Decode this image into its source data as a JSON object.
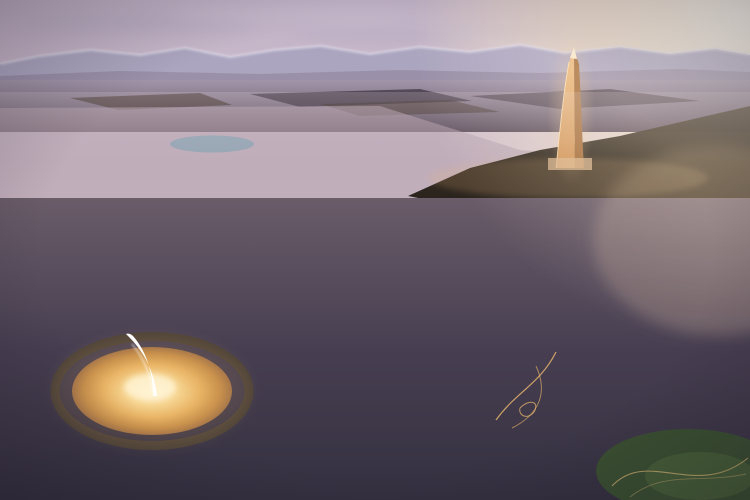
{
  "meta": {
    "title": "Dusk aerial rendering of a master-planned desert city",
    "landmarks": [
      "mountain-range",
      "sun-glow",
      "iconic-golden-tower",
      "cbd-cluster",
      "central-monument-plaza",
      "crescent-buildings",
      "green-boulevards",
      "city-park",
      "lakes"
    ]
  },
  "scene": {
    "seed": 1337,
    "counts": {
      "mid_buildings": 640,
      "mid_lights": 170,
      "desert_lights": 20,
      "cbd_towers": 30,
      "cbd_back": 16,
      "tower_windows": 95,
      "fg_buildings": 560,
      "fg_trees": 350,
      "park_trees": 42,
      "plaza_rays": 36,
      "rim_lights": 40
    },
    "palette": {
      "sky_top": "#c2b3c7",
      "sky_mid": "#d8c6d1",
      "sky_horizon": "#eedfdc",
      "cloud": "#b3a9bf",
      "sun_core": "#fff8e8",
      "sun_warm": "#f8e2bd",
      "warm_wash": "#f6c18c",
      "mountain": "#aaa3bf",
      "mountain_snow": "#dcd8e6",
      "ridge_near": "#968ba2",
      "plain_top": "#a295a9",
      "plain_bottom": "#5c4e5c",
      "field_dark": "#332a37",
      "field_brown": "#3d3028",
      "desert_top": "#372e23",
      "desert_bottom": "#1f1a14",
      "mid_base": "#b29fac",
      "mid_tints": [
        "#d8c4c6",
        "#cbb3bd",
        "#e2d1cb",
        "#c0acba",
        "#d3bab4",
        "#bfa8ae"
      ],
      "road_glow": "#f5c473",
      "road_bright": "#f8d084",
      "lake": "#91a4b4",
      "cbd_tints": [
        "#ecdccb",
        "#dfd0c2",
        "#f2e4d0",
        "#d5c4b8",
        "#e6d3bd"
      ],
      "cbd_shade": "#b5a294",
      "tower_lit": "#f0bd82",
      "tower_lit2": "#cf9258",
      "tower_shade": "#a76f3e",
      "tower_tip": "#ffeccb",
      "tower_dark": "#744b24",
      "tower_glow": "#f6cb92",
      "fg_top": "#6a5c69",
      "fg_mid": "#473f51",
      "fg_bottom": "#343040",
      "road_dark": "#4d4459",
      "median_green": "#47593a",
      "roof_greens": [
        "#5d7246",
        "#6b7e50",
        "#4e6540",
        "#77885c"
      ],
      "roof_slates": [
        "#8b94a8",
        "#98a1b3",
        "#7e8aa0",
        "#a4abc0"
      ],
      "roof_cream": "#c7bab0",
      "facades": [
        "#6c6374",
        "#7a6f7e",
        "#887b87",
        "#5e5668",
        "#948695"
      ],
      "window_warm": "#ffd98c",
      "tree_greens": [
        "#2c4129",
        "#38522f",
        "#243823",
        "#42603a"
      ],
      "plaza_core": "#fff7e0",
      "plaza_g1": "#f7d795",
      "plaza_g2": "#e9b465",
      "plaza_g3": "#c9914c",
      "plaza_edge": "#a9784a",
      "ring_road": "#4e4339",
      "rim_light": "#ffd98a",
      "ray": "#bf8848",
      "monument": "#ffffff",
      "monument_glow": "#fff3d2",
      "crescent_roofs": [
        "#8f98ac",
        "#7e89a1",
        "#959eb2"
      ],
      "crescent_facade": "#665e70",
      "park_green": "#3a5130",
      "park_light": "#49623a",
      "path_light": "#ecc27e"
    }
  }
}
